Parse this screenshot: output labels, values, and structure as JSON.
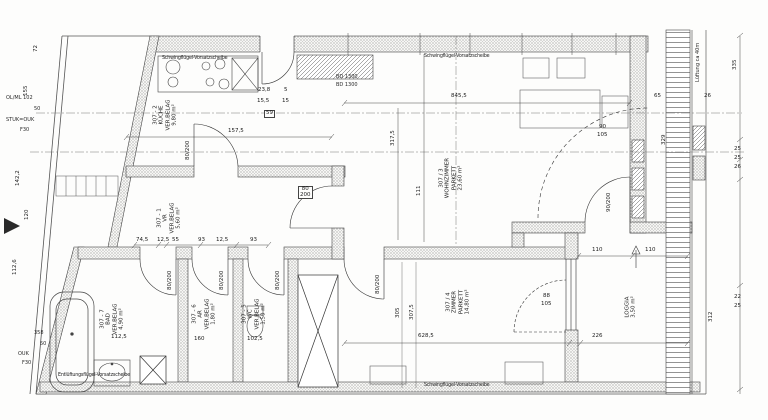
{
  "plan": {
    "unit_prefix": "307",
    "window_notes": {
      "top_left": "Schwingflügel-Vorsatzscheibe",
      "top_right": "Schwingflügel-Vorsatzscheibe",
      "bottom_left": "Entlüftungsflügel-Vorsatzscheibe",
      "bottom_right": "Schwingflügel-Vorsatzscheibe"
    },
    "wall_notes": {
      "ol_ml": "OL/ML 102",
      "n50": "50",
      "stuk": "STUK=OUK",
      "f30": "F30",
      "bl_358": "358",
      "bl_50": "50",
      "ouk": "OUK",
      "f30b": "F30",
      "lueftung": "Lüftung ca 40m",
      "cupboard1": "BD 1300",
      "cupboard2": "BD 1300"
    },
    "rooms": {
      "vr": {
        "number": "307 - 1",
        "name": "VR",
        "floor": "VER.BELAG",
        "area": "5,60 m²"
      },
      "kueche": {
        "number": "307 - 2",
        "name": "KÜCHE",
        "floor": "VER.BELAG",
        "area": "9,80 m²"
      },
      "wohnzimmer": {
        "number": "307 / 3",
        "name": "WOHNZIMMER",
        "floor": "PARKETT",
        "area": "23,60 m²"
      },
      "zimmer": {
        "number": "307 / 4",
        "name": "ZIMMER",
        "floor": "PARKETT",
        "area": "14,80 m²"
      },
      "wc": {
        "number": "307 - 5",
        "name": "WC",
        "floor": "VER.BELAG",
        "area": "1,50 m²"
      },
      "ar": {
        "number": "307 - 6",
        "name": "AR",
        "floor": "VER.BELAG",
        "area": "1,80 m²"
      },
      "bad": {
        "number": "307 - 7",
        "name": "BAD",
        "floor": "VER.BELAG",
        "area": "4,90 m²"
      },
      "loggia": {
        "name": "LOGGIA",
        "area": "3,50 m²"
      }
    },
    "doors": {
      "standard": "80/200",
      "living_loggia": "90/200",
      "hall_living_w": "80",
      "hall_living_h": "200",
      "lr_window_w": "90",
      "lr_window_h": "105",
      "zi_window_w": "88",
      "zi_window_h": "105"
    },
    "dims": {
      "left_72": "72",
      "left_155": "155",
      "left_1422": "142,2",
      "left_120": "120",
      "left_1126": "112,6",
      "k_238": "23,8",
      "k_5": "5",
      "k_155": "15,5",
      "k_15": "15",
      "k_59": "59",
      "k_1575": "157,5",
      "chain_745": "74,5",
      "chain_125": "12,5",
      "chain_55": "55",
      "chain_93": "93",
      "lr_8455": "845,5",
      "lr_3175": "317,5",
      "lr_111": "111",
      "lr_65": "65",
      "lr_26": "26",
      "zi_6285": "628,5",
      "zi_305": "305",
      "zi_3075": "307,5",
      "lg_226": "226",
      "lg_110": "110",
      "bad_1125": "112,5",
      "ar_160": "160",
      "wc_1025": "102,5",
      "r_335": "335",
      "r_329": "329",
      "r_25": "25",
      "r_26": "26",
      "r_312": "312",
      "r_22": "22"
    }
  }
}
